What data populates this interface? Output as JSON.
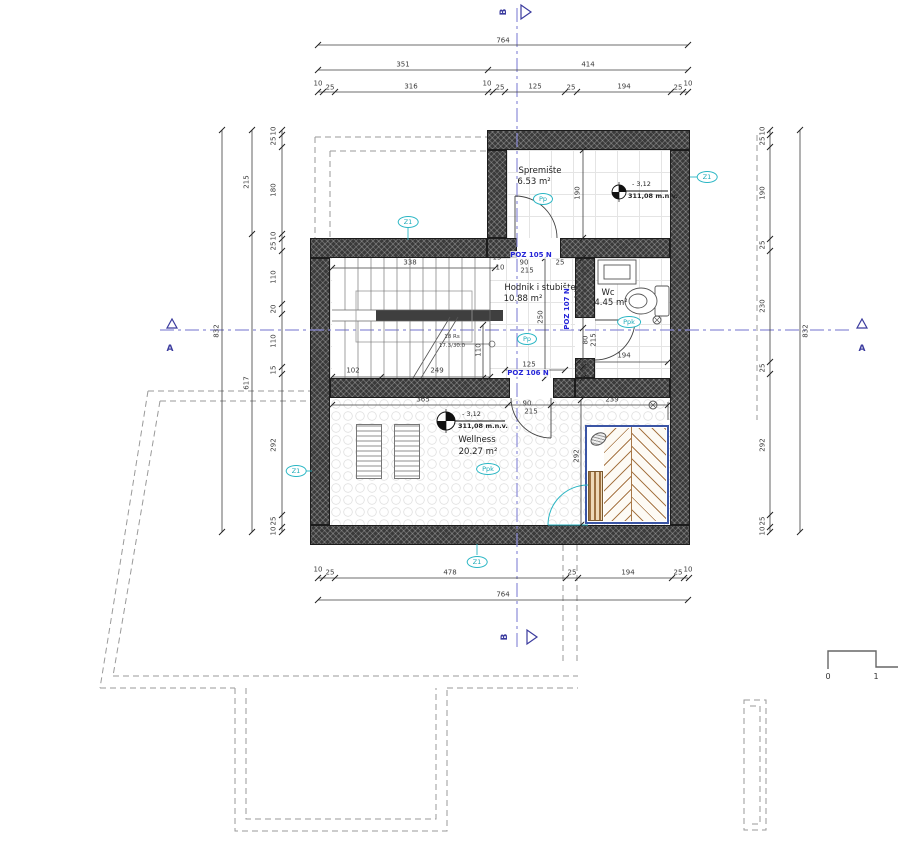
{
  "drawing": {
    "zone": "Z1",
    "rooms": {
      "spremiste": {
        "name": "Spremište",
        "area": "6.53 m²",
        "tag": "Pp"
      },
      "hodnik": {
        "name": "Hodnik i stubište",
        "area": "10.88 m²",
        "tag": "Pp"
      },
      "wc": {
        "name": "Wc",
        "area": "4.45 m²",
        "tag": "Ppk"
      },
      "wellness": {
        "name": "Wellness",
        "area": "20.27 m²",
        "tag": "Ppk"
      }
    },
    "elevations": {
      "spremiste": {
        "value": "- 3,12",
        "datum": "311,08 m.n.v."
      },
      "wellness": {
        "value": "- 3,12",
        "datum": "311,08 m.n.v."
      }
    },
    "poz": {
      "p105": "POZ 105 N",
      "p107": "POZ 107 N",
      "p106": "POZ 106 N"
    },
    "sections": {
      "a": "A",
      "b": "B"
    },
    "stairs": {
      "line1": "18 Rs",
      "line2": "17.3/30.0"
    },
    "scalebar": {
      "zero": "0",
      "one": "1"
    },
    "dims": {
      "top_total": "764",
      "top_major": [
        "351",
        "414"
      ],
      "top_detail": [
        "10",
        "25",
        "316",
        "10",
        "25",
        "125",
        "25",
        "194",
        "25",
        "10"
      ],
      "bottom_detail": [
        "10",
        "25",
        "478",
        "25",
        "194",
        "25",
        "10"
      ],
      "bottom_total": "764",
      "left_total": "832",
      "left_major": [
        "215",
        "617"
      ],
      "left_detail": [
        "10",
        "25",
        "180",
        "10",
        "25",
        "110",
        "20",
        "110",
        "15",
        "292",
        "25",
        "10"
      ],
      "right_total": "832",
      "right_detail": [
        "10",
        "25",
        "190",
        "25",
        "230",
        "25",
        "292",
        "25",
        "10"
      ],
      "interior": {
        "stair_top": "338",
        "stair_b1": "102",
        "stair_b2": "249",
        "stair_r": "110",
        "hodnik_h": "250",
        "hodnik_w": "125",
        "d105_w": "90",
        "d105_h": "215",
        "d105_s1": "15",
        "d105_s2": "10",
        "d105_s3": "25",
        "sprem_h": "190",
        "wc_h": "145",
        "wc_door_w": "80",
        "wc_door_h": "215",
        "wc_s": "30",
        "wc_w": "194",
        "well_w": "365",
        "well_door_w": "90",
        "well_door_h": "215",
        "sauna_w": "239",
        "sauna_h": "292"
      }
    }
  }
}
